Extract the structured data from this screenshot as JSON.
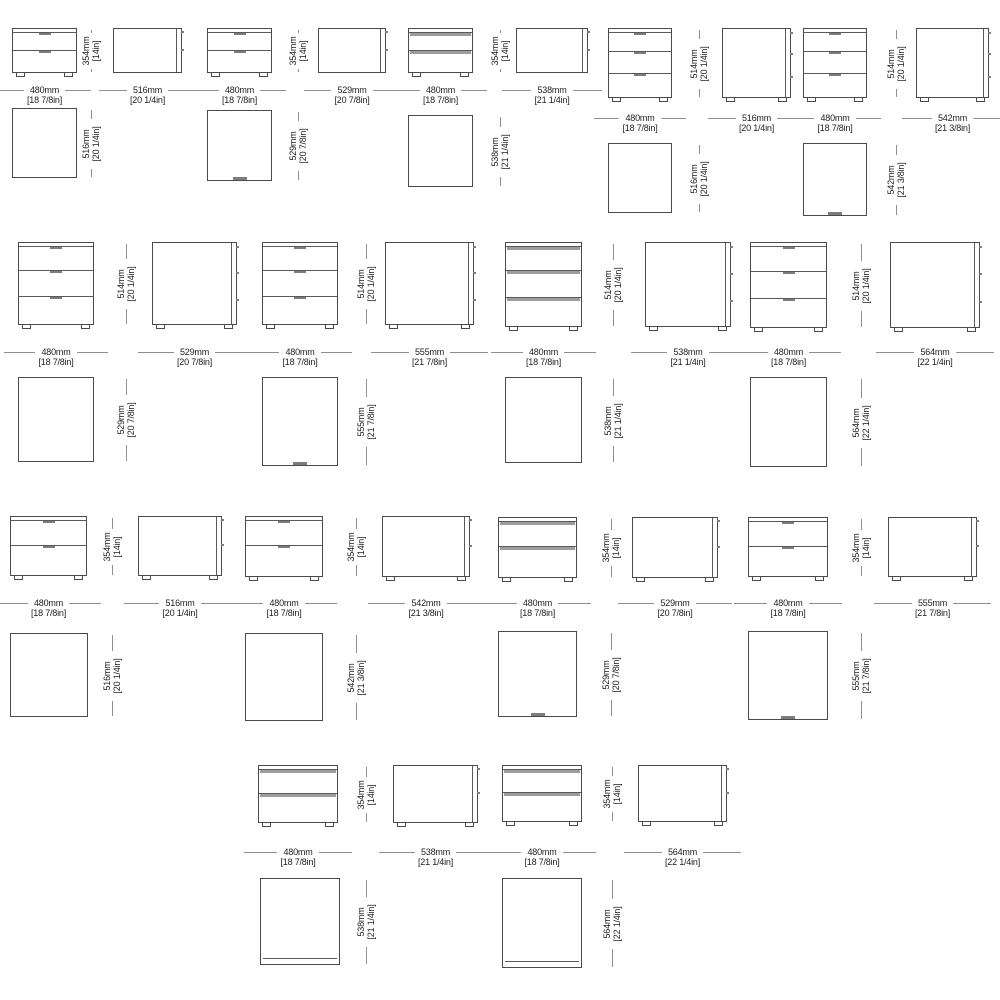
{
  "sheet": {
    "name": "nightstand-dimension-sheet",
    "background": "#ffffff",
    "line_color": "#4a4a4a",
    "dim_line_color": "#8f8f8f",
    "text_color": "#1d1d1d",
    "handle_strip_color": "#9c9c9c"
  },
  "rows": [
    {
      "name": "row-1",
      "modules": [
        {
          "view": "front",
          "drawers": 2,
          "handle": "tick",
          "bx": 12,
          "by": 28,
          "bw": 65,
          "bh": 45,
          "ly": 90,
          "hx": 91,
          "width_dim": {
            "mm": "480mm",
            "in": "[18 7/8in]"
          },
          "height_dim": {
            "mm": "354mm",
            "in": "[14in]"
          },
          "plan": {
            "x": 12,
            "y": 108,
            "w": 65,
            "h": 70,
            "tick": false,
            "base": false,
            "depth_dim": {
              "mm": "516mm",
              "in": "[20 1/4in]"
            }
          }
        },
        {
          "view": "side",
          "drawers": 2,
          "feet": false,
          "bx": 113,
          "by": 28,
          "bw": 69,
          "bh": 45,
          "ly": 90,
          "width_dim": {
            "mm": "516mm",
            "in": "[20 1/4in]"
          }
        },
        {
          "view": "front",
          "drawers": 2,
          "handle": "tick",
          "bx": 207,
          "by": 28,
          "bw": 65,
          "bh": 45,
          "ly": 90,
          "hx": 298,
          "width_dim": {
            "mm": "480mm",
            "in": "[18 7/8in]"
          },
          "height_dim": {
            "mm": "354mm",
            "in": "[14in]"
          },
          "plan": {
            "x": 207,
            "y": 110,
            "w": 65,
            "h": 71,
            "tick": true,
            "base": false,
            "depth_dim": {
              "mm": "529mm",
              "in": "[20 7/8in]"
            }
          }
        },
        {
          "view": "side",
          "drawers": 2,
          "feet": false,
          "bx": 318,
          "by": 28,
          "bw": 68,
          "bh": 45,
          "ly": 90,
          "width_dim": {
            "mm": "529mm",
            "in": "[20 7/8in]"
          }
        },
        {
          "view": "front",
          "drawers": 2,
          "handle": "strip",
          "bx": 408,
          "by": 28,
          "bw": 65,
          "bh": 45,
          "ly": 90,
          "hx": 500,
          "width_dim": {
            "mm": "480mm",
            "in": "[18 7/8in]"
          },
          "height_dim": {
            "mm": "354mm",
            "in": "[14in]"
          },
          "plan": {
            "x": 408,
            "y": 115,
            "w": 65,
            "h": 72,
            "tick": false,
            "base": false,
            "depth_dim": {
              "mm": "538mm",
              "in": "[21 1/4in]"
            }
          }
        },
        {
          "view": "side",
          "drawers": 2,
          "feet": false,
          "bx": 516,
          "by": 28,
          "bw": 72,
          "bh": 45,
          "ly": 90,
          "width_dim": {
            "mm": "538mm",
            "in": "[21 1/4in]"
          }
        },
        {
          "view": "front",
          "drawers": 3,
          "handle": "tick",
          "bx": 608,
          "by": 28,
          "bw": 64,
          "bh": 70,
          "ly": 118,
          "hx": 699,
          "width_dim": {
            "mm": "480mm",
            "in": "[18 7/8in]"
          },
          "height_dim": {
            "mm": "514mm",
            "in": "[20 1/4in]"
          },
          "plan": {
            "x": 608,
            "y": 143,
            "w": 64,
            "h": 70,
            "tick": false,
            "base": false,
            "depth_dim": {
              "mm": "516mm",
              "in": "[20 1/4in]"
            }
          }
        },
        {
          "view": "side",
          "drawers": 3,
          "feet": true,
          "bx": 722,
          "by": 28,
          "bw": 69,
          "bh": 70,
          "ly": 118,
          "width_dim": {
            "mm": "516mm",
            "in": "[20 1/4in]"
          }
        },
        {
          "view": "front",
          "drawers": 3,
          "handle": "tick",
          "bx": 803,
          "by": 28,
          "bw": 64,
          "bh": 70,
          "ly": 118,
          "hx": 896,
          "width_dim": {
            "mm": "480mm",
            "in": "[18 7/8in]"
          },
          "height_dim": {
            "mm": "514mm",
            "in": "[20 1/4in]"
          },
          "plan": {
            "x": 803,
            "y": 143,
            "w": 64,
            "h": 73,
            "tick": true,
            "base": false,
            "depth_dim": {
              "mm": "542mm",
              "in": "[21 3/8in]"
            }
          }
        },
        {
          "view": "side",
          "drawers": 3,
          "feet": true,
          "bx": 916,
          "by": 28,
          "bw": 73,
          "bh": 70,
          "ly": 118,
          "width_dim": {
            "mm": "542mm",
            "in": "[21 3/8in]"
          }
        }
      ]
    },
    {
      "name": "row-2",
      "modules": [
        {
          "view": "front",
          "drawers": 3,
          "handle": "tick",
          "bx": 18,
          "by": 242,
          "bw": 76,
          "bh": 83,
          "ly": 352,
          "hx": 126,
          "width_dim": {
            "mm": "480mm",
            "in": "[18 7/8in]"
          },
          "height_dim": {
            "mm": "514mm",
            "in": "[20 1/4in]"
          },
          "plan": {
            "x": 18,
            "y": 377,
            "w": 76,
            "h": 85,
            "tick": false,
            "base": false,
            "depth_dim": {
              "mm": "529mm",
              "in": "[20 7/8in]"
            }
          }
        },
        {
          "view": "side",
          "drawers": 3,
          "feet": true,
          "bx": 152,
          "by": 242,
          "bw": 85,
          "bh": 83,
          "ly": 352,
          "width_dim": {
            "mm": "529mm",
            "in": "[20 7/8in]"
          }
        },
        {
          "view": "front",
          "drawers": 3,
          "handle": "tick",
          "bx": 262,
          "by": 242,
          "bw": 76,
          "bh": 83,
          "ly": 352,
          "hx": 366,
          "width_dim": {
            "mm": "480mm",
            "in": "[18 7/8in]"
          },
          "height_dim": {
            "mm": "514mm",
            "in": "[20 1/4in]"
          },
          "plan": {
            "x": 262,
            "y": 377,
            "w": 76,
            "h": 89,
            "tick": true,
            "base": false,
            "depth_dim": {
              "mm": "555mm",
              "in": "[21 7/8in]"
            }
          }
        },
        {
          "view": "side",
          "drawers": 3,
          "feet": true,
          "bx": 385,
          "by": 242,
          "bw": 89,
          "bh": 83,
          "ly": 352,
          "width_dim": {
            "mm": "555mm",
            "in": "[21 7/8in]"
          }
        },
        {
          "view": "front",
          "drawers": 3,
          "handle": "strip",
          "bx": 505,
          "by": 242,
          "bw": 77,
          "bh": 85,
          "ly": 352,
          "hx": 613,
          "width_dim": {
            "mm": "480mm",
            "in": "[18 7/8in]"
          },
          "height_dim": {
            "mm": "514mm",
            "in": "[20 1/4in]"
          },
          "plan": {
            "x": 505,
            "y": 377,
            "w": 77,
            "h": 86,
            "tick": false,
            "base": false,
            "depth_dim": {
              "mm": "538mm",
              "in": "[21 1/4in]"
            }
          }
        },
        {
          "view": "side",
          "drawers": 3,
          "feet": true,
          "bx": 645,
          "by": 242,
          "bw": 86,
          "bh": 85,
          "ly": 352,
          "width_dim": {
            "mm": "538mm",
            "in": "[21 1/4in]"
          }
        },
        {
          "view": "front",
          "drawers": 3,
          "handle": "tick",
          "bx": 750,
          "by": 242,
          "bw": 77,
          "bh": 86,
          "ly": 352,
          "hx": 861,
          "width_dim": {
            "mm": "480mm",
            "in": "[18 7/8in]"
          },
          "height_dim": {
            "mm": "514mm",
            "in": "[20 1/4in]"
          },
          "plan": {
            "x": 750,
            "y": 377,
            "w": 77,
            "h": 90,
            "tick": false,
            "base": false,
            "depth_dim": {
              "mm": "564mm",
              "in": "[22 1/4in]"
            }
          }
        },
        {
          "view": "side",
          "drawers": 3,
          "feet": true,
          "bx": 890,
          "by": 242,
          "bw": 90,
          "bh": 86,
          "ly": 352,
          "width_dim": {
            "mm": "564mm",
            "in": "[22 1/4in]"
          }
        }
      ]
    },
    {
      "name": "row-3",
      "modules": [
        {
          "view": "front",
          "drawers": 2,
          "handle": "tick",
          "bx": 10,
          "by": 516,
          "bw": 77,
          "bh": 60,
          "ly": 603,
          "hx": 112,
          "width_dim": {
            "mm": "480mm",
            "in": "[18 7/8in]"
          },
          "height_dim": {
            "mm": "354mm",
            "in": "[14in]"
          },
          "plan": {
            "x": 10,
            "y": 633,
            "w": 78,
            "h": 84,
            "tick": false,
            "base": false,
            "depth_dim": {
              "mm": "516mm",
              "in": "[20 1/4in]"
            }
          }
        },
        {
          "view": "side",
          "drawers": 2,
          "feet": true,
          "bx": 138,
          "by": 516,
          "bw": 84,
          "bh": 60,
          "ly": 603,
          "width_dim": {
            "mm": "516mm",
            "in": "[20 1/4in]"
          }
        },
        {
          "view": "front",
          "drawers": 2,
          "handle": "tick",
          "bx": 245,
          "by": 516,
          "bw": 78,
          "bh": 61,
          "ly": 603,
          "hx": 356,
          "width_dim": {
            "mm": "480mm",
            "in": "[18 7/8in]"
          },
          "height_dim": {
            "mm": "354mm",
            "in": "[14in]"
          },
          "plan": {
            "x": 245,
            "y": 633,
            "w": 78,
            "h": 88,
            "tick": false,
            "base": false,
            "depth_dim": {
              "mm": "542mm",
              "in": "[21 3/8in]"
            }
          }
        },
        {
          "view": "side",
          "drawers": 2,
          "feet": true,
          "bx": 382,
          "by": 516,
          "bw": 88,
          "bh": 61,
          "ly": 603,
          "width_dim": {
            "mm": "542mm",
            "in": "[21 3/8in]"
          }
        },
        {
          "view": "front",
          "drawers": 2,
          "handle": "strip",
          "bx": 498,
          "by": 517,
          "bw": 79,
          "bh": 61,
          "ly": 603,
          "hx": 611,
          "width_dim": {
            "mm": "480mm",
            "in": "[18 7/8in]"
          },
          "height_dim": {
            "mm": "354mm",
            "in": "[14in]"
          },
          "plan": {
            "x": 498,
            "y": 631,
            "w": 79,
            "h": 86,
            "tick": true,
            "base": false,
            "depth_dim": {
              "mm": "529mm",
              "in": "[20 7/8in]"
            }
          }
        },
        {
          "view": "side",
          "drawers": 2,
          "feet": true,
          "bx": 632,
          "by": 517,
          "bw": 86,
          "bh": 61,
          "ly": 603,
          "width_dim": {
            "mm": "529mm",
            "in": "[20 7/8in]"
          }
        },
        {
          "view": "front",
          "drawers": 2,
          "handle": "tick",
          "bx": 748,
          "by": 517,
          "bw": 80,
          "bh": 60,
          "ly": 603,
          "hx": 861,
          "width_dim": {
            "mm": "480mm",
            "in": "[18 7/8in]"
          },
          "height_dim": {
            "mm": "354mm",
            "in": "[14in]"
          },
          "plan": {
            "x": 748,
            "y": 631,
            "w": 80,
            "h": 89,
            "tick": true,
            "base": false,
            "depth_dim": {
              "mm": "555mm",
              "in": "[21 7/8in]"
            }
          }
        },
        {
          "view": "side",
          "drawers": 2,
          "feet": true,
          "bx": 888,
          "by": 517,
          "bw": 89,
          "bh": 60,
          "ly": 603,
          "width_dim": {
            "mm": "555mm",
            "in": "[21 7/8in]"
          }
        }
      ]
    },
    {
      "name": "row-4",
      "modules": [
        {
          "view": "front",
          "drawers": 2,
          "handle": "strip",
          "bx": 258,
          "by": 765,
          "bw": 80,
          "bh": 58,
          "ly": 852,
          "hx": 366,
          "width_dim": {
            "mm": "480mm",
            "in": "[18 7/8in]"
          },
          "height_dim": {
            "mm": "354mm",
            "in": "[14in]"
          },
          "plan": {
            "x": 260,
            "y": 878,
            "w": 80,
            "h": 87,
            "tick": false,
            "base": true,
            "depth_dim": {
              "mm": "538mm",
              "in": "[21 1/4in]"
            }
          }
        },
        {
          "view": "side",
          "drawers": 2,
          "feet": true,
          "bx": 393,
          "by": 765,
          "bw": 85,
          "bh": 58,
          "ly": 852,
          "width_dim": {
            "mm": "538mm",
            "in": "[21 1/4in]"
          }
        },
        {
          "view": "front",
          "drawers": 2,
          "handle": "strip",
          "bx": 502,
          "by": 765,
          "bw": 80,
          "bh": 57,
          "ly": 852,
          "hx": 612,
          "width_dim": {
            "mm": "480mm",
            "in": "[18 7/8in]"
          },
          "height_dim": {
            "mm": "354mm",
            "in": "[14in]"
          },
          "plan": {
            "x": 502,
            "y": 878,
            "w": 80,
            "h": 90,
            "tick": false,
            "base": true,
            "depth_dim": {
              "mm": "564mm",
              "in": "[22 1/4in]"
            }
          }
        },
        {
          "view": "side",
          "drawers": 2,
          "feet": true,
          "bx": 638,
          "by": 765,
          "bw": 89,
          "bh": 57,
          "ly": 852,
          "width_dim": {
            "mm": "564mm",
            "in": "[22 1/4in]"
          }
        }
      ]
    }
  ]
}
